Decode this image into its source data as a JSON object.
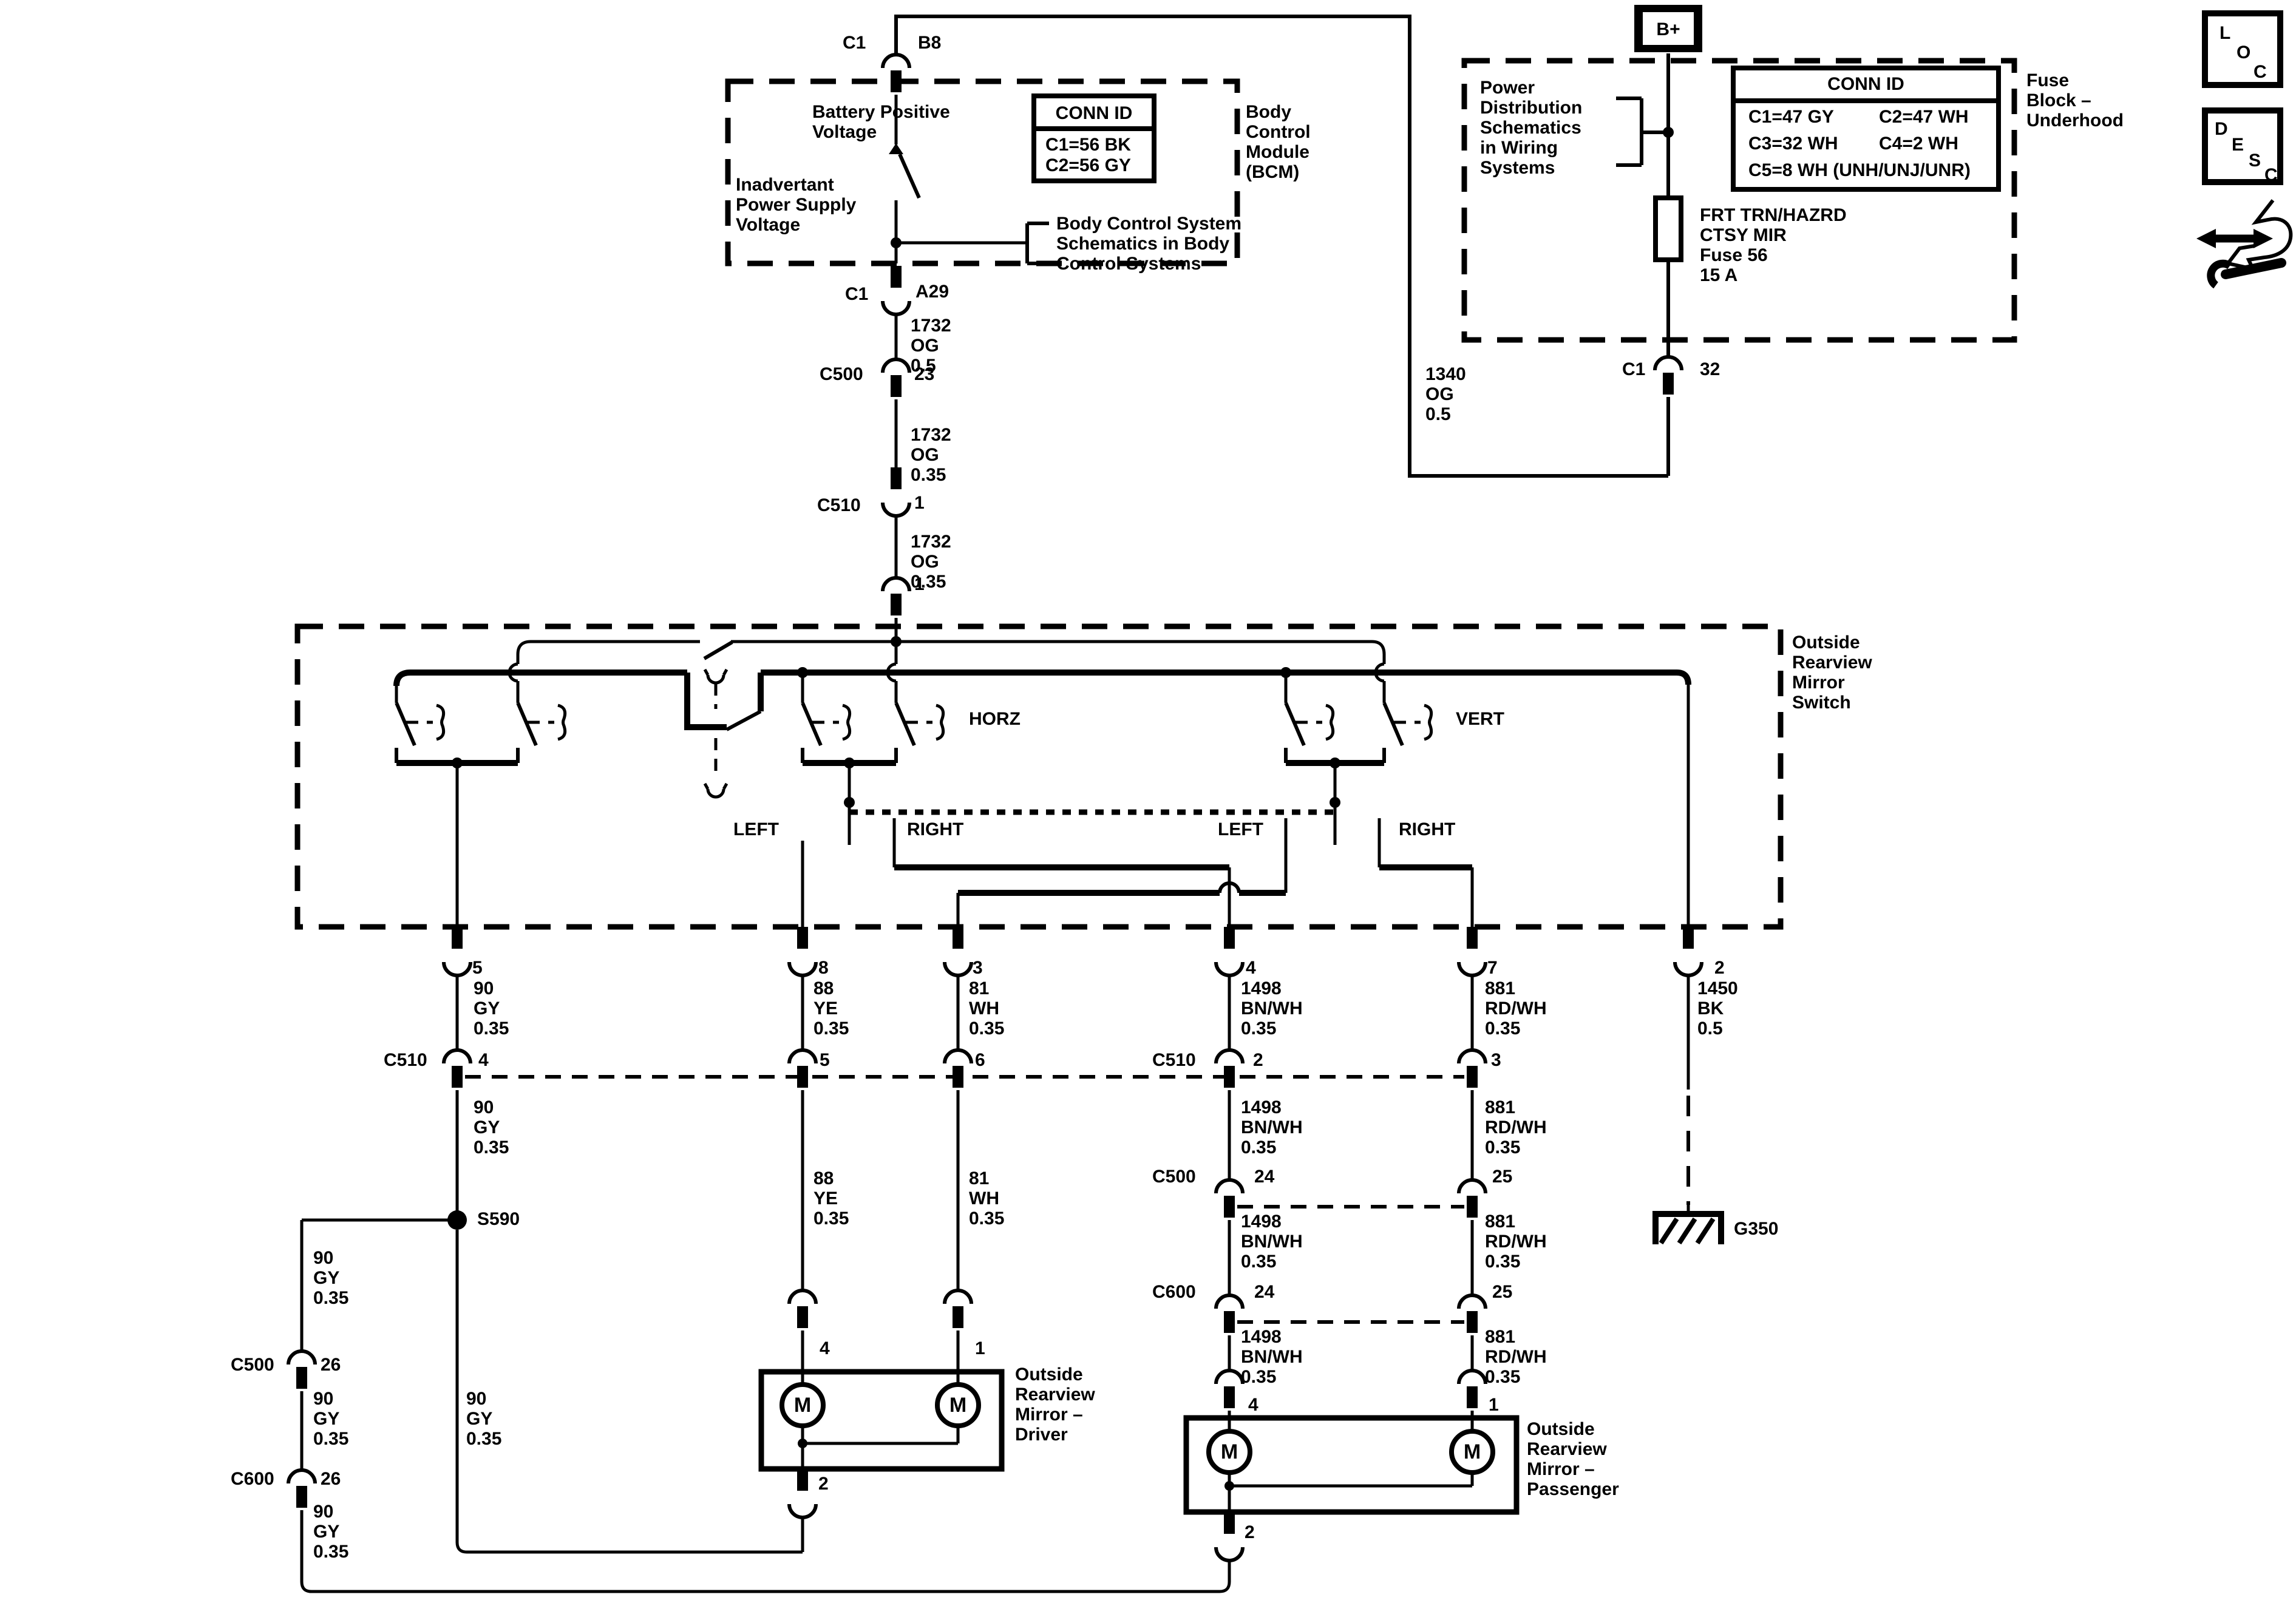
{
  "top": {
    "c1": "C1",
    "b8": "B8"
  },
  "bcm": {
    "battery": "Battery Positive\nVoltage",
    "inadvertant": "Inadvertant\nPower Supply\nVoltage",
    "conn_title": "CONN ID",
    "conn_row1": "C1=56 BK",
    "conn_row2": "C2=56 GY",
    "schematics": "Body Control System\nSchematics in Body\nControl Systems",
    "module": "Body\nControl\nModule\n(BCM)"
  },
  "bcm_out": {
    "c1": "C1",
    "a29": "A29",
    "wire1": "1732\nOG\n0.5",
    "c500": "C500",
    "pin23": "23",
    "wire2": "1732\nOG\n0.35",
    "c510": "C510",
    "pin1": "1",
    "wire3": "1732\nOG\n0.35",
    "pin1b": "1"
  },
  "fuse": {
    "bplus": "B+",
    "power": "Power\nDistribution\nSchematics\nin Wiring\nSystems",
    "conn_title": "CONN ID",
    "c1": "C1=47 GY",
    "c2": "C2=47 WH",
    "c3": "C3=32 WH",
    "c4": "C4=2 WH",
    "c5": "C5=8 WH (UNH/UNJ/UNR)",
    "title": "Fuse\nBlock –\nUnderhood",
    "fuse_label": "FRT TRN/HAZRD\nCTSY MIR\nFuse 56\n15 A",
    "c1_out": "C1",
    "pin32": "32",
    "wire": "1340\nOG\n0.5"
  },
  "switch": {
    "title": "Outside\nRearview\nMirror\nSwitch",
    "horz": "HORZ",
    "vert": "VERT",
    "left1": "LEFT",
    "right1": "RIGHT",
    "left2": "LEFT",
    "right2": "RIGHT",
    "pin5": "5",
    "pin8": "8",
    "pin3": "3",
    "pin4": "4",
    "pin7": "7",
    "pin2": "2"
  },
  "wires": {
    "gy": "90\nGY\n0.35",
    "ye": "88\nYE\n0.35",
    "wh": "81\nWH\n0.35",
    "bnwh": "1498\nBN/WH\n0.35",
    "rdwh": "881\nRD/WH\n0.35",
    "bk": "1450\nBK\n0.5"
  },
  "conn": {
    "c510_left": "C510",
    "c510_pass": "C510",
    "c500_left": "C500",
    "c500_pass": "C500",
    "c600_left": "C600",
    "c600_pass": "C600",
    "p4": "4",
    "p5": "5",
    "p6": "6",
    "p2": "2",
    "p3": "3",
    "p26a": "26",
    "p26b": "26",
    "p24a": "24",
    "p24b": "24",
    "p25a": "25",
    "p25b": "25"
  },
  "splice": {
    "s590": "S590"
  },
  "ground": {
    "g350": "G350"
  },
  "driver": {
    "pin4": "4",
    "pin1": "1",
    "pin2": "2",
    "m1": "M",
    "m2": "M",
    "label": "Outside\nRearview\nMirror –\nDriver"
  },
  "passenger": {
    "pin4": "4",
    "pin1": "1",
    "pin2": "2",
    "m1": "M",
    "m2": "M",
    "label": "Outside\nRearview\nMirror –\nPassenger"
  },
  "icons": {
    "loc": [
      "L",
      "O",
      "C"
    ],
    "desc": [
      "D",
      "E",
      "S",
      "C"
    ]
  }
}
